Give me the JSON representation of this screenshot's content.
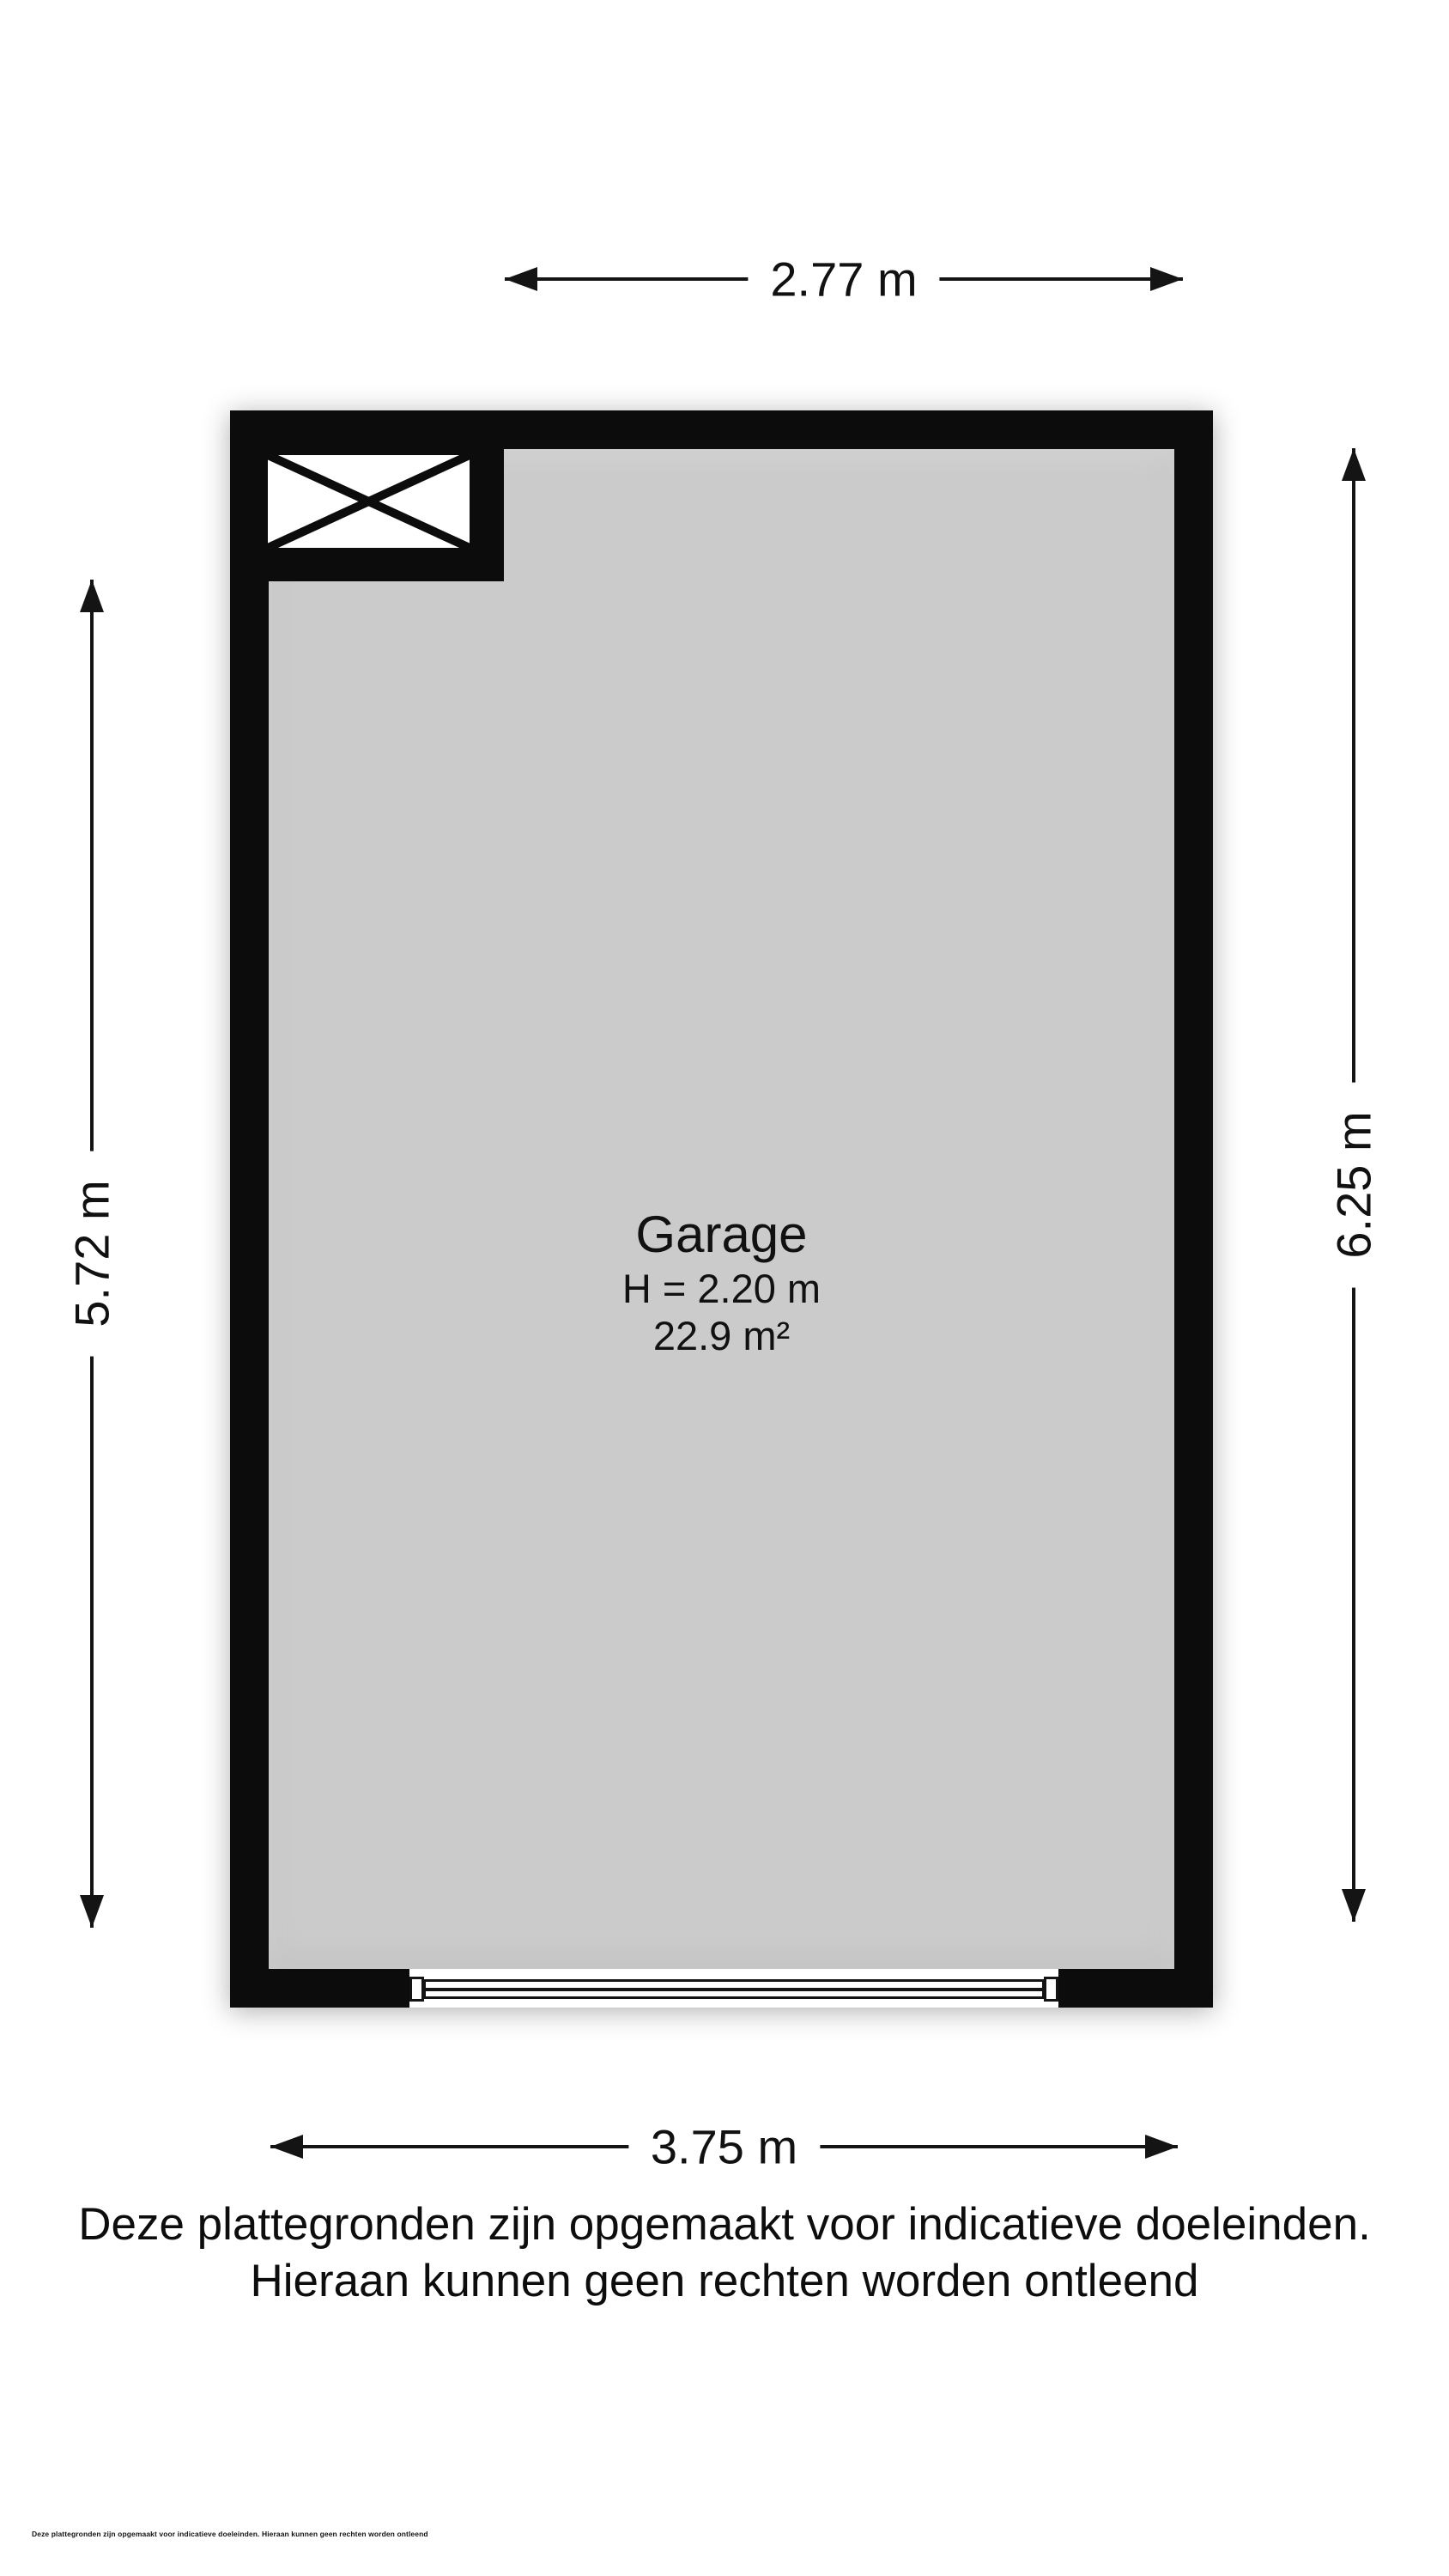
{
  "floorplan": {
    "room": {
      "name": "Garage",
      "height": "H = 2.20 m",
      "area": "22.9 m²"
    },
    "colors": {
      "wall": "#0c0c0c",
      "floor": "#cbcbcb",
      "text": "#111111",
      "background": "#ffffff"
    }
  },
  "dimensions": {
    "top": "2.77 m",
    "bottom": "3.75 m",
    "left": "5.72 m",
    "right": "6.25 m"
  },
  "disclaimer": {
    "line1": "Deze plattegronden zijn opgemaakt voor indicatieve doeleinden.",
    "line2": "Hieraan kunnen geen rechten worden ontleend"
  },
  "footnote": "Deze plattegronden zijn opgemaakt voor indicatieve doeleinden. Hieraan kunnen geen rechten worden ontleend"
}
